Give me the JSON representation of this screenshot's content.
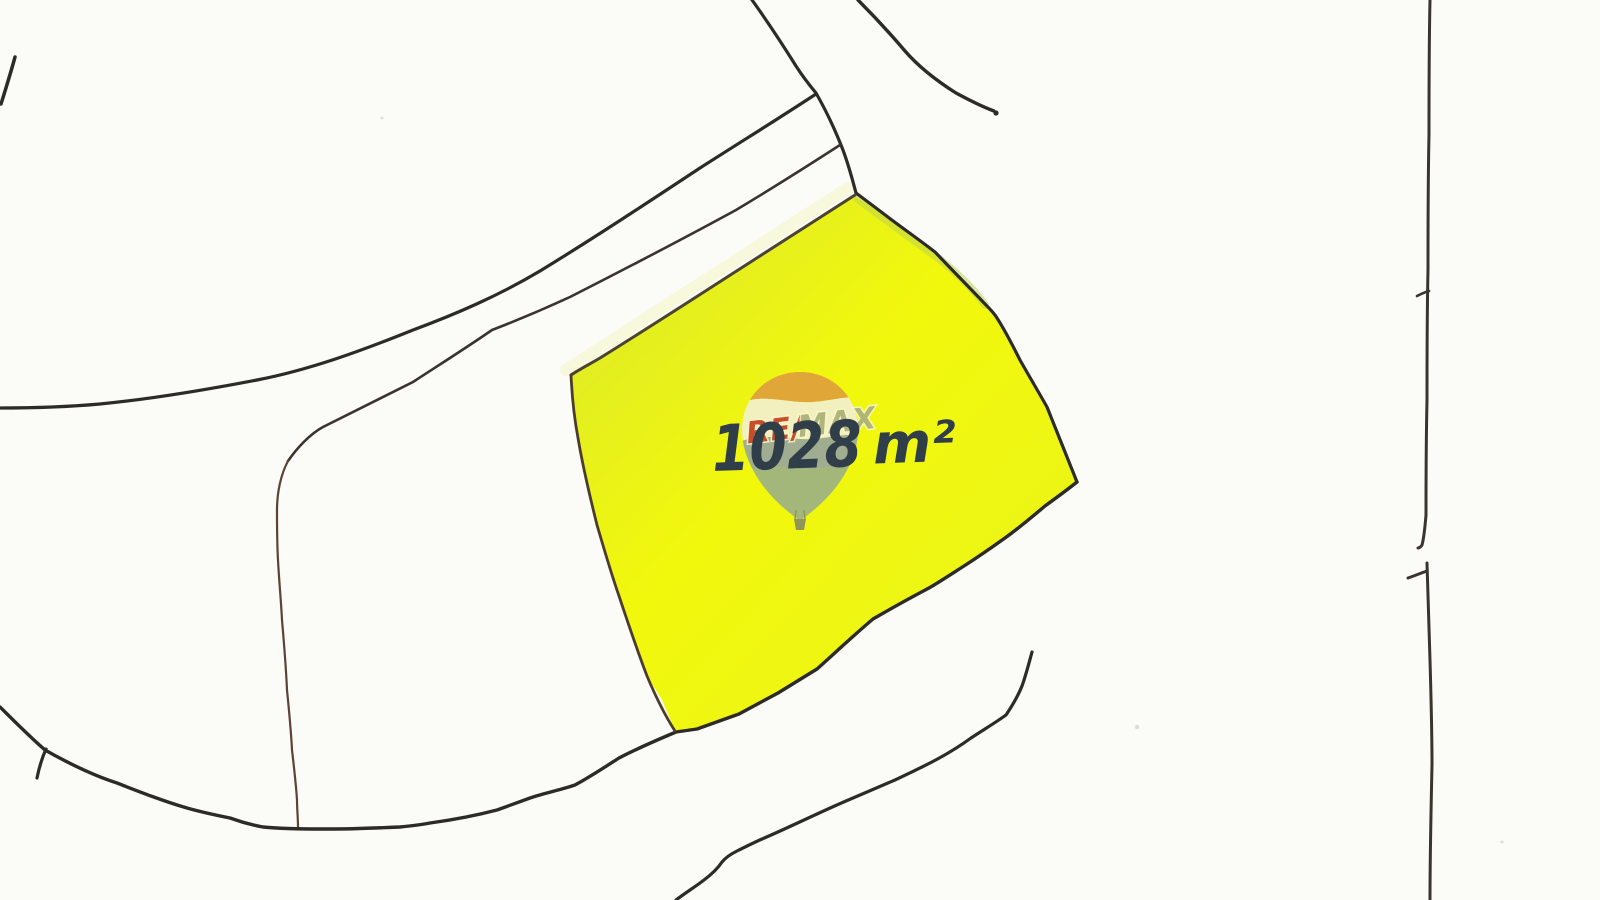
{
  "document": {
    "kind": "hand-drawn cadastral parcel sketch (scanned)",
    "area_label": "1028 m²",
    "area_value": "1028",
    "area_unit": "m²"
  },
  "watermark": {
    "icon": "hot-air-balloon-icon",
    "brand_left": "RE/",
    "brand_right": "MAX"
  },
  "colors": {
    "paper": "#fbfbf7",
    "parcel_fill_edge": "#d9e72e",
    "parcel_fill": "#e9f31c",
    "parcel_fill_light": "#f2f80c",
    "ink_black": "#2c2b27",
    "ink_grey": "#3a342e",
    "ink_brown": "#4c3c2f",
    "ink_maroon": "#5d4335",
    "ink_olive": "#4a4430",
    "handwriting_ink": "#2f3e49",
    "edge_tint_green": "#b9cf52",
    "edge_haze_yellow": "#eef3a0",
    "balloon_top": "#dfa13c",
    "balloon_band": "#f4f0cd",
    "balloon_hills": "#9ba89a",
    "balloon_bottom": "#9db382",
    "balloon_basket": "#8a8e5f",
    "brand_red": "#c5422d",
    "brand_muted": "#a3a87c",
    "speck": "#c9c9c0"
  }
}
